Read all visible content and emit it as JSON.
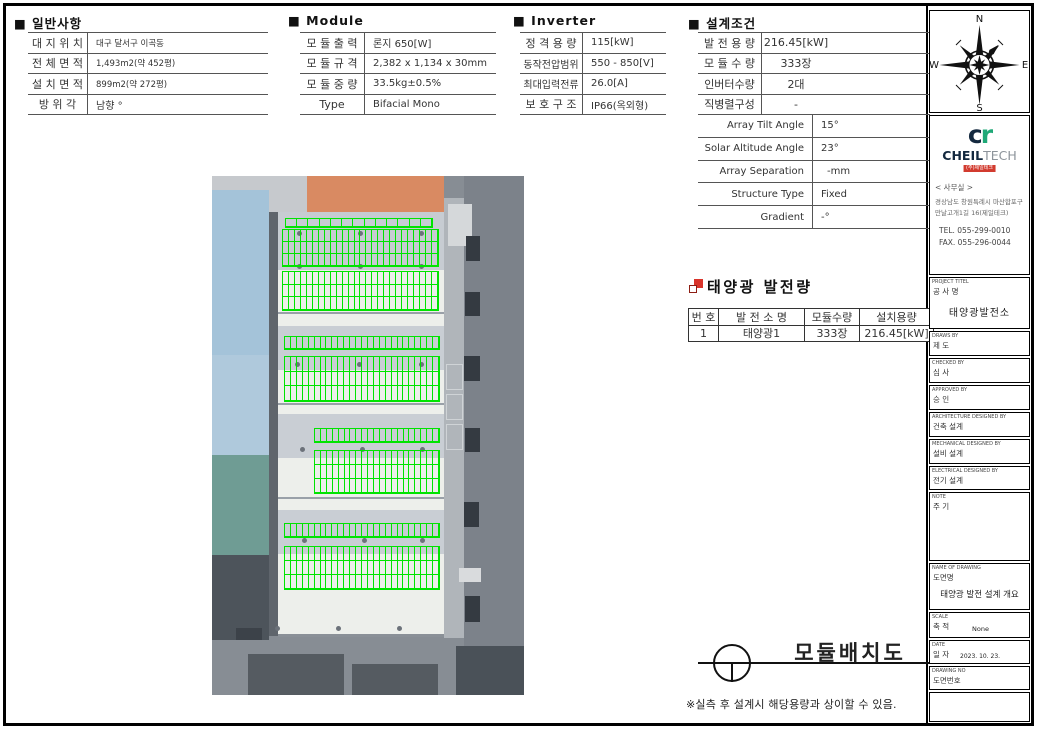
{
  "sheet": {
    "drawing_title": "모듈배치도",
    "footnote": "※실측 후 설계시 해당용량과 상이할 수 있음."
  },
  "general": {
    "header": "■ 일반사항",
    "rows": [
      {
        "label": "대 지 위 치",
        "value": "대구 달서구 이곡동"
      },
      {
        "label": "전 체 면 적",
        "value": "1,493m2(약 452평)"
      },
      {
        "label": "설 치 면 적",
        "value": "899m2(약 272평)"
      },
      {
        "label": "방 위 각",
        "value": "남향 °"
      }
    ]
  },
  "module": {
    "header": "■ Module",
    "rows": [
      {
        "label": "모 듈 출 력",
        "value": "론지 650[W]"
      },
      {
        "label": "모 듈 규 격",
        "value": "2,382 x 1,134 x 30mm"
      },
      {
        "label": "모 듈 중 량",
        "value": "33.5kg±0.5%"
      },
      {
        "label": "Type",
        "value": "Bifacial Mono"
      }
    ]
  },
  "inverter": {
    "header": "■ Inverter",
    "rows": [
      {
        "label": "정 격 용 량",
        "value": "115[kW]"
      },
      {
        "label": "동작전압범위",
        "value": "550 - 850[V]"
      },
      {
        "label": "최대입력전류",
        "value": "26.0[A]"
      },
      {
        "label": "보 호 구 조",
        "value": "IP66(옥외형)"
      }
    ]
  },
  "design": {
    "header": "■ 설계조건",
    "rows": [
      {
        "label": "발 전 용 량",
        "value": "216.45[kW]"
      },
      {
        "label": "모 듈 수 량",
        "value": "333장"
      },
      {
        "label": "인버터수량",
        "value": "2대"
      },
      {
        "label": "직병렬구성",
        "value": "-"
      }
    ],
    "rows_en": [
      {
        "label": "Array Tilt Angle",
        "value": "15°"
      },
      {
        "label": "Solar Altitude Angle",
        "value": "23°"
      },
      {
        "label": "Array Separation",
        "value": "-mm"
      },
      {
        "label": "Structure Type",
        "value": "Fixed"
      },
      {
        "label": "Gradient",
        "value": "-°"
      }
    ]
  },
  "generation": {
    "title": "태양광 발전량",
    "headers": [
      "번 호",
      "발 전 소 명",
      "모듈수량",
      "설치용량"
    ],
    "row": [
      "1",
      "태양광1",
      "333장",
      "216.45[kW]"
    ]
  },
  "compass": {
    "n": "N",
    "s": "S",
    "e": "E",
    "w": "W"
  },
  "company": {
    "logo_c": "c",
    "logo_r": "r",
    "name_bold": "CHEIL",
    "name_light": "TECH",
    "badge": "(주)제일테크",
    "office": "< 사무실 >",
    "address1": "경상남도 창원특례시 마산합포구",
    "address2": "만날고개1길 16(제일테크)",
    "tel": "TEL. 055-299-0010",
    "fax": "FAX. 055-296-0044"
  },
  "titleblock": {
    "boxes": [
      {
        "en": "PROJECT TITEL",
        "kr": "공 사 명",
        "value": "태양광발전소"
      },
      {
        "en": "DRAWS BY",
        "kr": "제  도",
        "value": ""
      },
      {
        "en": "CHECKED BY",
        "kr": "심  사",
        "value": ""
      },
      {
        "en": "APPROVED BY",
        "kr": "승  인",
        "value": ""
      },
      {
        "en": "ARCHITECTURE DESIGNED BY",
        "kr": "건축 설계",
        "value": ""
      },
      {
        "en": "MECHANICAL DESIGNED BY",
        "kr": "설비 설계",
        "value": ""
      },
      {
        "en": "ELECTRICAL DESIGNED BY",
        "kr": "전기 설계",
        "value": ""
      },
      {
        "en": "NOTE",
        "kr": "주  기",
        "value": ""
      },
      {
        "en": "NAME OF DRAWING",
        "kr": "도면명",
        "value": "태양광 발전 설계 개요"
      },
      {
        "en": "SCALE",
        "kr": "축  적",
        "value": "None"
      },
      {
        "en": "DATE",
        "kr": "일  자",
        "value": "2023. 10. 23."
      },
      {
        "en": "DRAWING NO",
        "kr": "도면번호",
        "value": ""
      }
    ]
  },
  "site_plan": {
    "panel_color": "#00e400",
    "panel_groups": [
      {
        "x": 73,
        "y": 42,
        "w": 148,
        "h": 10,
        "rows": 1,
        "cols": 13
      },
      {
        "x": 70,
        "y": 53,
        "w": 157,
        "h": 38,
        "rows": 3,
        "cols": 26
      },
      {
        "x": 70,
        "y": 95,
        "w": 157,
        "h": 40,
        "rows": 3,
        "cols": 26
      },
      {
        "x": 72,
        "y": 160,
        "w": 156,
        "h": 14,
        "rows": 1,
        "cols": 26
      },
      {
        "x": 72,
        "y": 180,
        "w": 156,
        "h": 46,
        "rows": 3,
        "cols": 26
      },
      {
        "x": 102,
        "y": 252,
        "w": 126,
        "h": 15,
        "rows": 1,
        "cols": 21
      },
      {
        "x": 102,
        "y": 274,
        "w": 126,
        "h": 44,
        "rows": 3,
        "cols": 21
      },
      {
        "x": 72,
        "y": 347,
        "w": 156,
        "h": 15,
        "rows": 1,
        "cols": 26
      },
      {
        "x": 72,
        "y": 370,
        "w": 156,
        "h": 44,
        "rows": 3,
        "cols": 26
      }
    ]
  }
}
